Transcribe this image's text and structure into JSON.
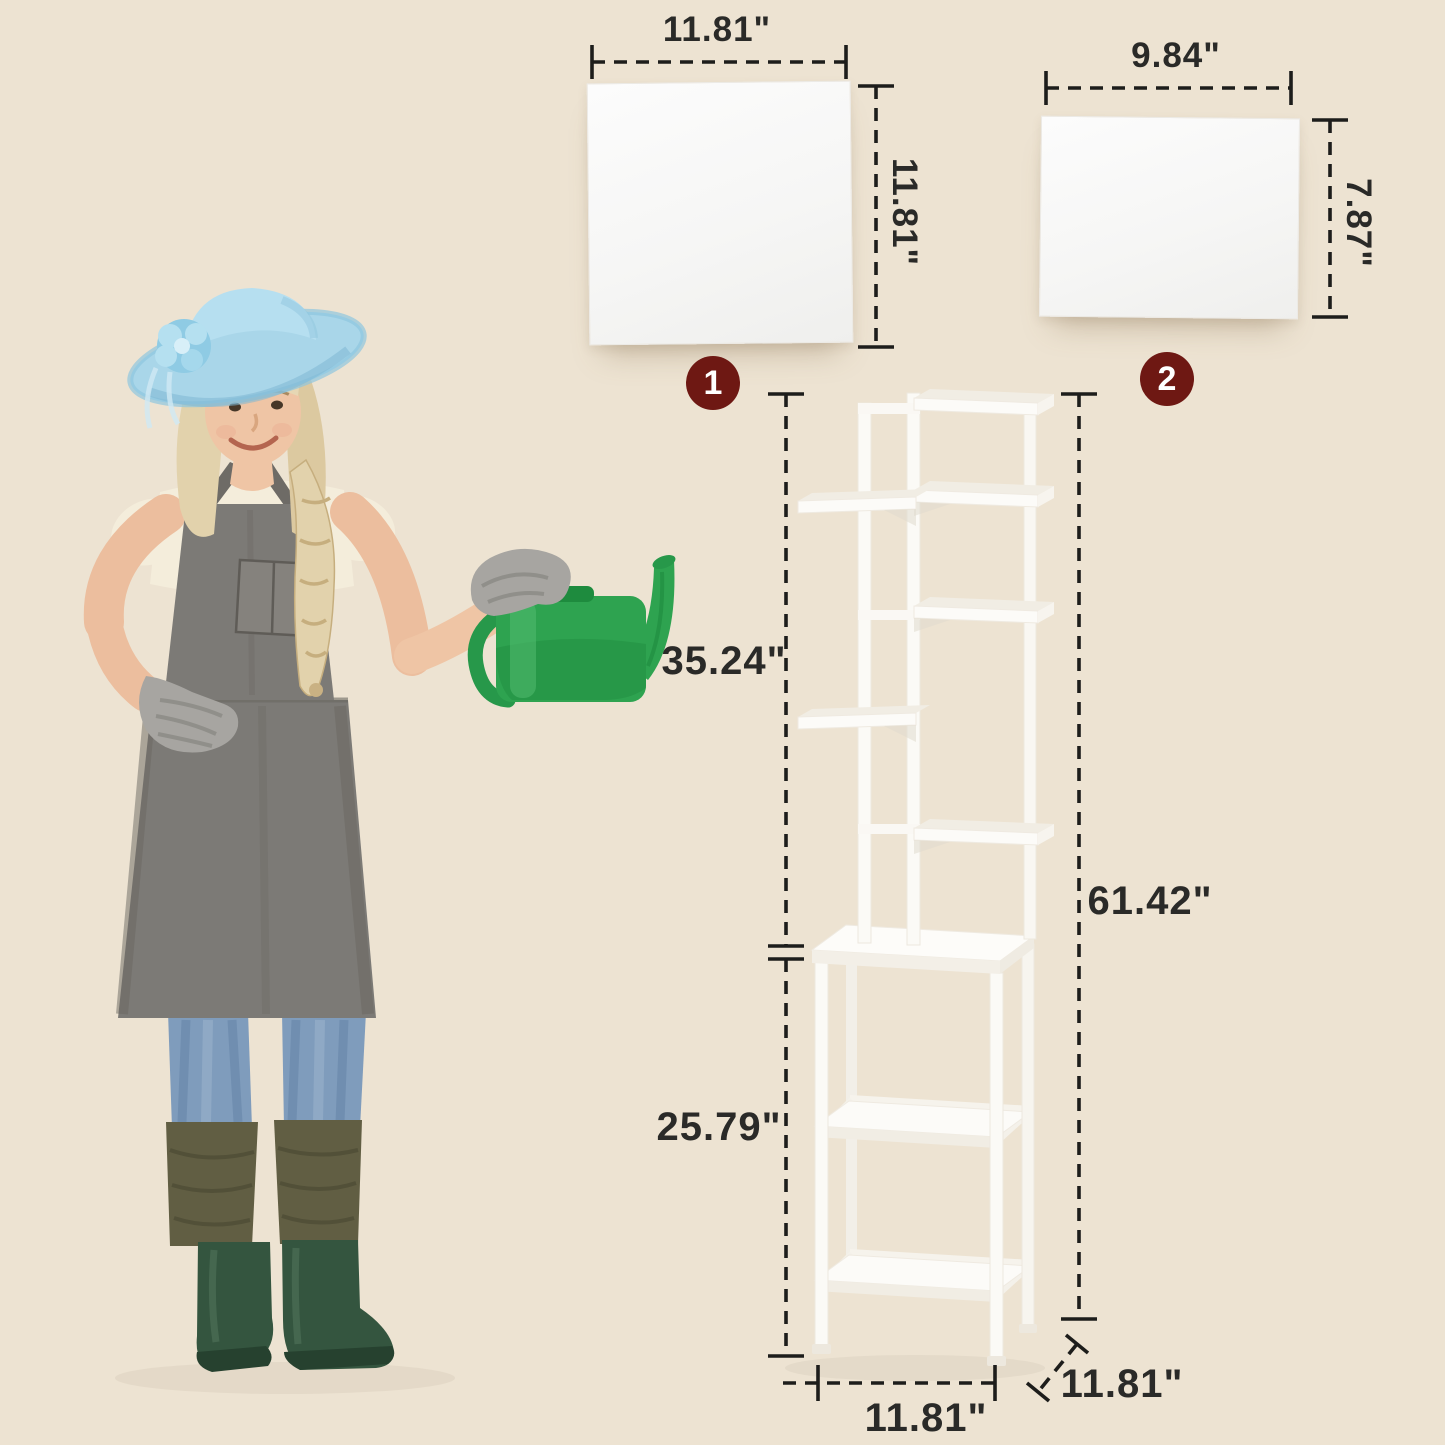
{
  "colors": {
    "background": "#EDE3D2",
    "badge_bg": "#6E1813",
    "badge_text": "#FFFFFF",
    "dimension_text": "#2A2A28",
    "dash_line": "#1D1D1B",
    "panel_white": "#F8F8F7",
    "shelf_white": "#FBFAF6",
    "hat_blue": "#A9D6E9",
    "apron_gray": "#7C7A76",
    "jeans_blue": "#7F9CBC",
    "boots_green": "#34553F",
    "can_green": "#2EA350"
  },
  "panels": [
    {
      "badge": "1",
      "width_label": "11.81\"",
      "height_label": "11.81\""
    },
    {
      "badge": "2",
      "width_label": "9.84\"",
      "height_label": "7.87\""
    }
  ],
  "shelf": {
    "upper_section": "35.24\"",
    "total_height": "61.42\"",
    "lower_section": "25.79\"",
    "base_width": "11.81\"",
    "base_depth": "11.81\""
  }
}
